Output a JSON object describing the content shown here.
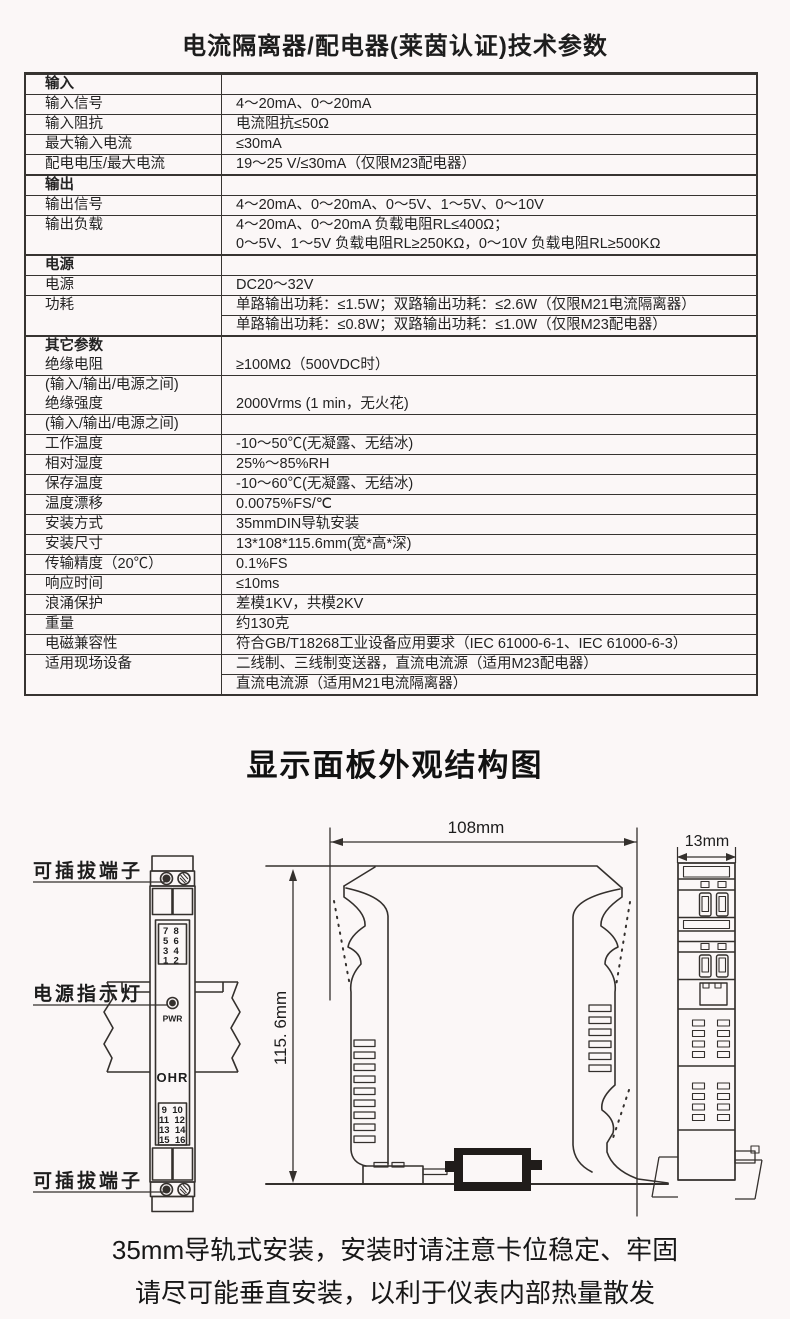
{
  "page": {
    "title": "电流隔离器/配电器(莱茵认证)技术参数",
    "section2_title": "显示面板外观结构图",
    "footer_line1": "35mm导轨式安装，安装时请注意卡位稳定、牢固",
    "footer_line2": "请尽可能垂直安装，以利于仪表内部热量散发"
  },
  "spec_table": {
    "rows": [
      {
        "label": [
          "输入"
        ],
        "value": []
      },
      {
        "label": [
          "输入信号"
        ],
        "value": [
          "4～20mA、0～20mA"
        ]
      },
      {
        "label": [
          "输入阻抗"
        ],
        "value": [
          "电流阻抗≤50Ω"
        ]
      },
      {
        "label": [
          "最大输入电流"
        ],
        "value": [
          "≤30mA"
        ]
      },
      {
        "label": [
          "配电电压/最大电流"
        ],
        "value": [
          "19～25 V/≤30mA（仅限M23配电器）"
        ]
      },
      {
        "label": [
          "输出"
        ],
        "value": []
      },
      {
        "label": [
          "输出信号"
        ],
        "value": [
          "4～20mA、0～20mA、0～5V、1～5V、0～10V"
        ]
      },
      {
        "label": [
          "输出负载"
        ],
        "value": [
          "4～20mA、0～20mA 负载电阻RL≤400Ω；",
          "0～5V、1～5V 负载电阻RL≥250KΩ，0～10V 负载电阻RL≥500KΩ"
        ]
      },
      {
        "label": [
          "电源"
        ],
        "value": []
      },
      {
        "label": [
          "电源"
        ],
        "value": [
          "DC20～32V"
        ]
      },
      {
        "label": [
          "功耗"
        ],
        "value": [
          "单路输出功耗：≤1.5W；双路输出功耗：≤2.6W（仅限M21电流隔离器）",
          "单路输出功耗：≤0.8W；双路输出功耗：≤1.0W（仅限M23配电器）"
        ]
      },
      {
        "label": [
          "其它参数",
          "绝缘电阻"
        ],
        "value": [
          "≥100MΩ（500VDC时）"
        ]
      },
      {
        "label": [
          "(输入/输出/电源之间)",
          "绝缘强度"
        ],
        "value": [
          "2000Vrms (1 min，无火花)"
        ]
      },
      {
        "label": [
          "(输入/输出/电源之间)"
        ],
        "value": []
      },
      {
        "label": [
          "工作温度"
        ],
        "value": [
          "-10～50℃(无凝露、无结冰)"
        ]
      },
      {
        "label": [
          "相对湿度"
        ],
        "value": [
          "25%～85%RH"
        ]
      },
      {
        "label": [
          "保存温度"
        ],
        "value": [
          "-10～60℃(无凝露、无结冰)"
        ]
      },
      {
        "label": [
          "温度漂移"
        ],
        "value": [
          "0.0075%FS/℃"
        ]
      },
      {
        "label": [
          "安装方式"
        ],
        "value": [
          "35mmDIN导轨安装"
        ]
      },
      {
        "label": [
          "安装尺寸"
        ],
        "value": [
          "13*108*115.6mm(宽*高*深)"
        ]
      },
      {
        "label": [
          "传输精度（20℃）"
        ],
        "value": [
          "0.1%FS"
        ]
      },
      {
        "label": [
          "响应时间"
        ],
        "value": [
          "≤10ms"
        ]
      },
      {
        "label": [
          "浪涌保护"
        ],
        "value": [
          "差模1KV，共模2KV"
        ]
      },
      {
        "label": [
          "重量"
        ],
        "value": [
          "约130克"
        ]
      },
      {
        "label": [
          "电磁兼容性"
        ],
        "value": [
          "符合GB/T18268工业设备应用要求（IEC 61000-6-1、IEC 61000-6-3）"
        ]
      },
      {
        "label": [
          "适用现场设备"
        ],
        "value": [
          "二线制、三线制变送器，直流电流源（适用M23配电器）",
          "直流电流源（适用M21电流隔离器）"
        ]
      }
    ]
  },
  "figure": {
    "label_terminal_top": "可插拔端子",
    "label_power_led": "电源指示灯",
    "label_terminal_bottom": "可插拔端子",
    "dim_width": "108mm",
    "dim_height": "115. 6mm",
    "dim_depth": "13mm",
    "front": {
      "top_terminals": [
        "7  8",
        "5  6",
        "3  4",
        "1  2"
      ],
      "bottom_terminals": [
        " 9  10",
        "11  12",
        "13  14",
        "15  16"
      ],
      "led_label": "PWR",
      "brand": "OHR"
    }
  }
}
